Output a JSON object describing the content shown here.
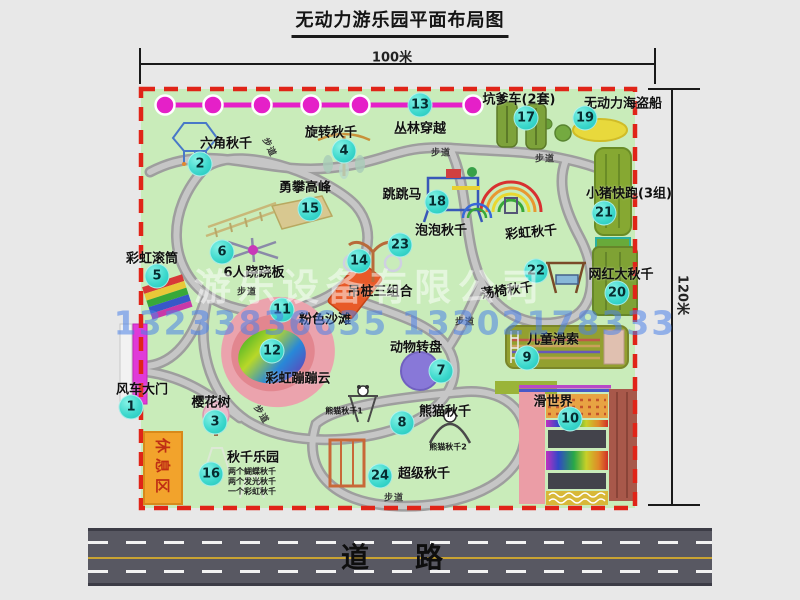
{
  "title": "无动力游乐园平面布局图",
  "dimensions": {
    "width_label": "100米",
    "height_label": "120米"
  },
  "road_label": "道路",
  "rest_area_label": "休息区",
  "path_label": "步道",
  "watermark": {
    "company": "游乐设备有限公司",
    "phones": "13233836635 13302178333"
  },
  "notes": {
    "rainbow_swing": "彩虹秋千",
    "panda1": "熊猫秋千1",
    "panda2": "熊猫秋千2",
    "swing_item1": "两个蝴蝶秋千",
    "swing_item2": "两个发光秋千",
    "swing_item3": "一个彩虹秋千"
  },
  "attractions": [
    {
      "num": "1",
      "label": "风车大门"
    },
    {
      "num": "2",
      "label": "六角秋千"
    },
    {
      "num": "3",
      "label": "樱花树"
    },
    {
      "num": "4",
      "label": "旋转秋千"
    },
    {
      "num": "5",
      "label": "彩虹滚筒"
    },
    {
      "num": "6",
      "label": "6人跷跷板"
    },
    {
      "num": "7",
      "label": "动物转盘"
    },
    {
      "num": "8",
      "label": "熊猫秋千"
    },
    {
      "num": "9",
      "label": "儿童滑索"
    },
    {
      "num": "10",
      "label": "滑世界"
    },
    {
      "num": "11",
      "label": "粉色沙滩"
    },
    {
      "num": "12",
      "label": "彩虹蹦蹦云"
    },
    {
      "num": "13",
      "label": "丛林穿越"
    },
    {
      "num": "14",
      "label": "吊桩三组合"
    },
    {
      "num": "15",
      "label": "勇攀高峰"
    },
    {
      "num": "16",
      "label": "秋千乐园"
    },
    {
      "num": "17",
      "label": "坑爹车(2套)"
    },
    {
      "num": "18",
      "label": "跳跳马"
    },
    {
      "num": "19",
      "label": "无动力海盗船"
    },
    {
      "num": "20",
      "label": "网红大秋千"
    },
    {
      "num": "21",
      "label": "小猪快跑(3组)"
    },
    {
      "num": "22",
      "label": "荡椅秋千"
    },
    {
      "num": "23",
      "label": "泡泡秋千"
    },
    {
      "num": "24",
      "label": "超级秋千"
    }
  ]
}
